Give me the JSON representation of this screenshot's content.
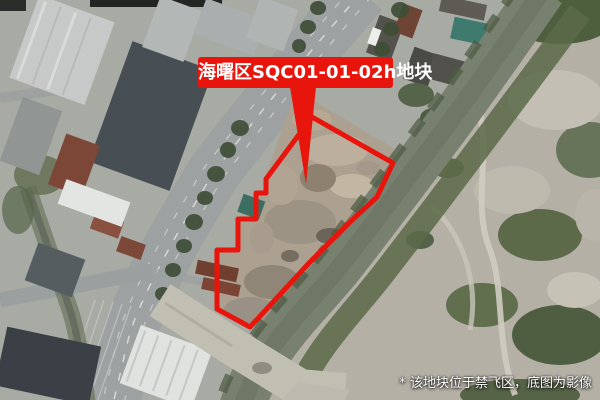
{
  "annotation": {
    "parcel_label": "海曙区SQC01-01-02h地块"
  },
  "footnote": {
    "text": "* 该地块位于禁飞区，底图为影像"
  },
  "colors": {
    "annotation_red": "#e8150c",
    "label_text": "#ffffff",
    "footnote_text": "#ffffff",
    "river_water": "#78806f",
    "vegetation_dark": "#48573c",
    "parcel_ground": "#aca090",
    "road_gray": "#9da1a2"
  }
}
